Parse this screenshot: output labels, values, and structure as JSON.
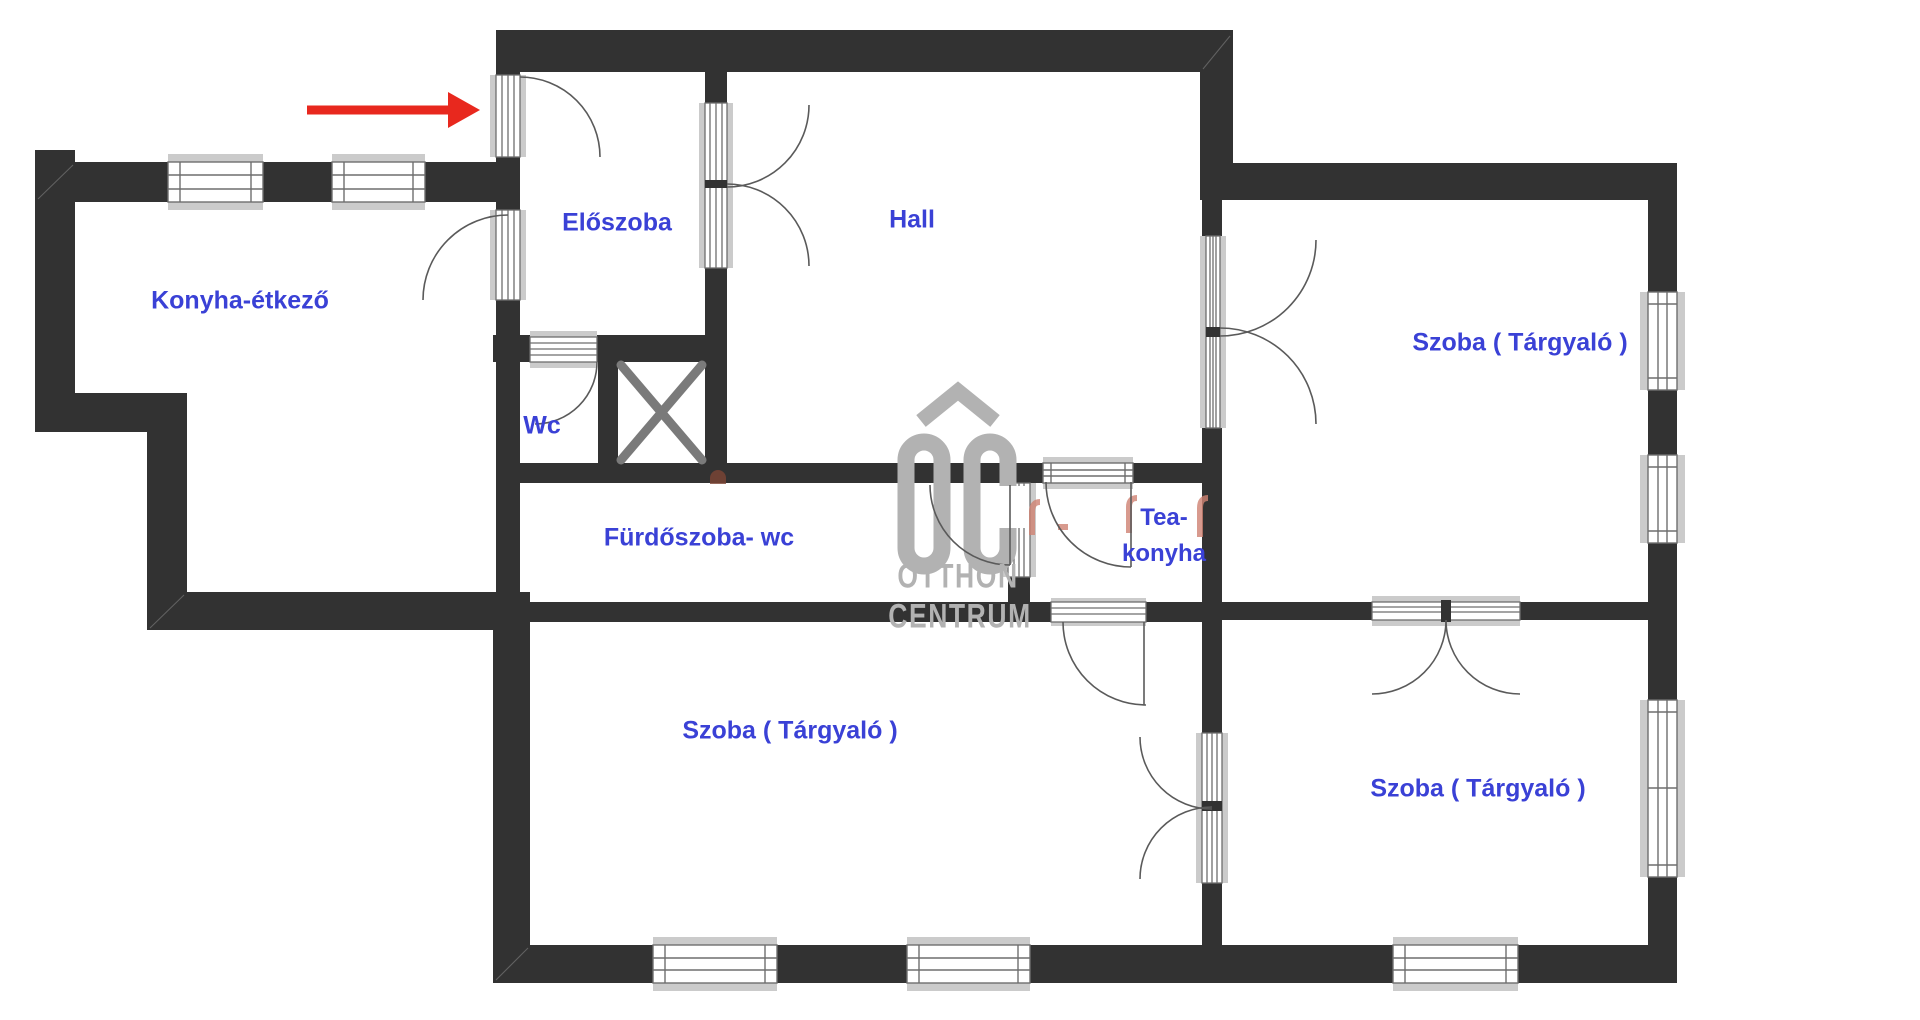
{
  "plan": {
    "type": "apartment floor plan",
    "rooms": [
      {
        "id": "konyha-etkezo",
        "label": "Konyha-étkező"
      },
      {
        "id": "eloszoba",
        "label": "Előszoba"
      },
      {
        "id": "hall",
        "label": "Hall"
      },
      {
        "id": "wc",
        "label": "Wc"
      },
      {
        "id": "furdoszoba-wc",
        "label": "Fürdőszoba- wc"
      },
      {
        "id": "tea-konyha",
        "label": "Tea-konyha",
        "line1": "Tea-",
        "line2": "konyha"
      },
      {
        "id": "szoba-targyalo-felso",
        "label": "Szoba ( Tárgyaló )"
      },
      {
        "id": "szoba-targyalo-also-bal",
        "label": "Szoba ( Tárgyaló )"
      },
      {
        "id": "szoba-targyalo-also-jobb",
        "label": "Szoba ( Tárgyaló )"
      }
    ],
    "annotations": {
      "entrance_arrow": {
        "meaning": "entrance",
        "direction": "right",
        "color": "#e8281e"
      }
    },
    "watermark": {
      "logo": "OC",
      "line1": "OTTHON",
      "line2": "CENTRUM",
      "color": "#b2b2b2"
    },
    "colors": {
      "wall": "#323232",
      "room_label": "#3a41d6",
      "window_sill": "#cbcbcb",
      "fixture_line": "#6e6e6e",
      "shaft_cross": "#7a7a7a",
      "arrow": "#e8281e",
      "watermark_remnant": "#cf8272"
    }
  }
}
